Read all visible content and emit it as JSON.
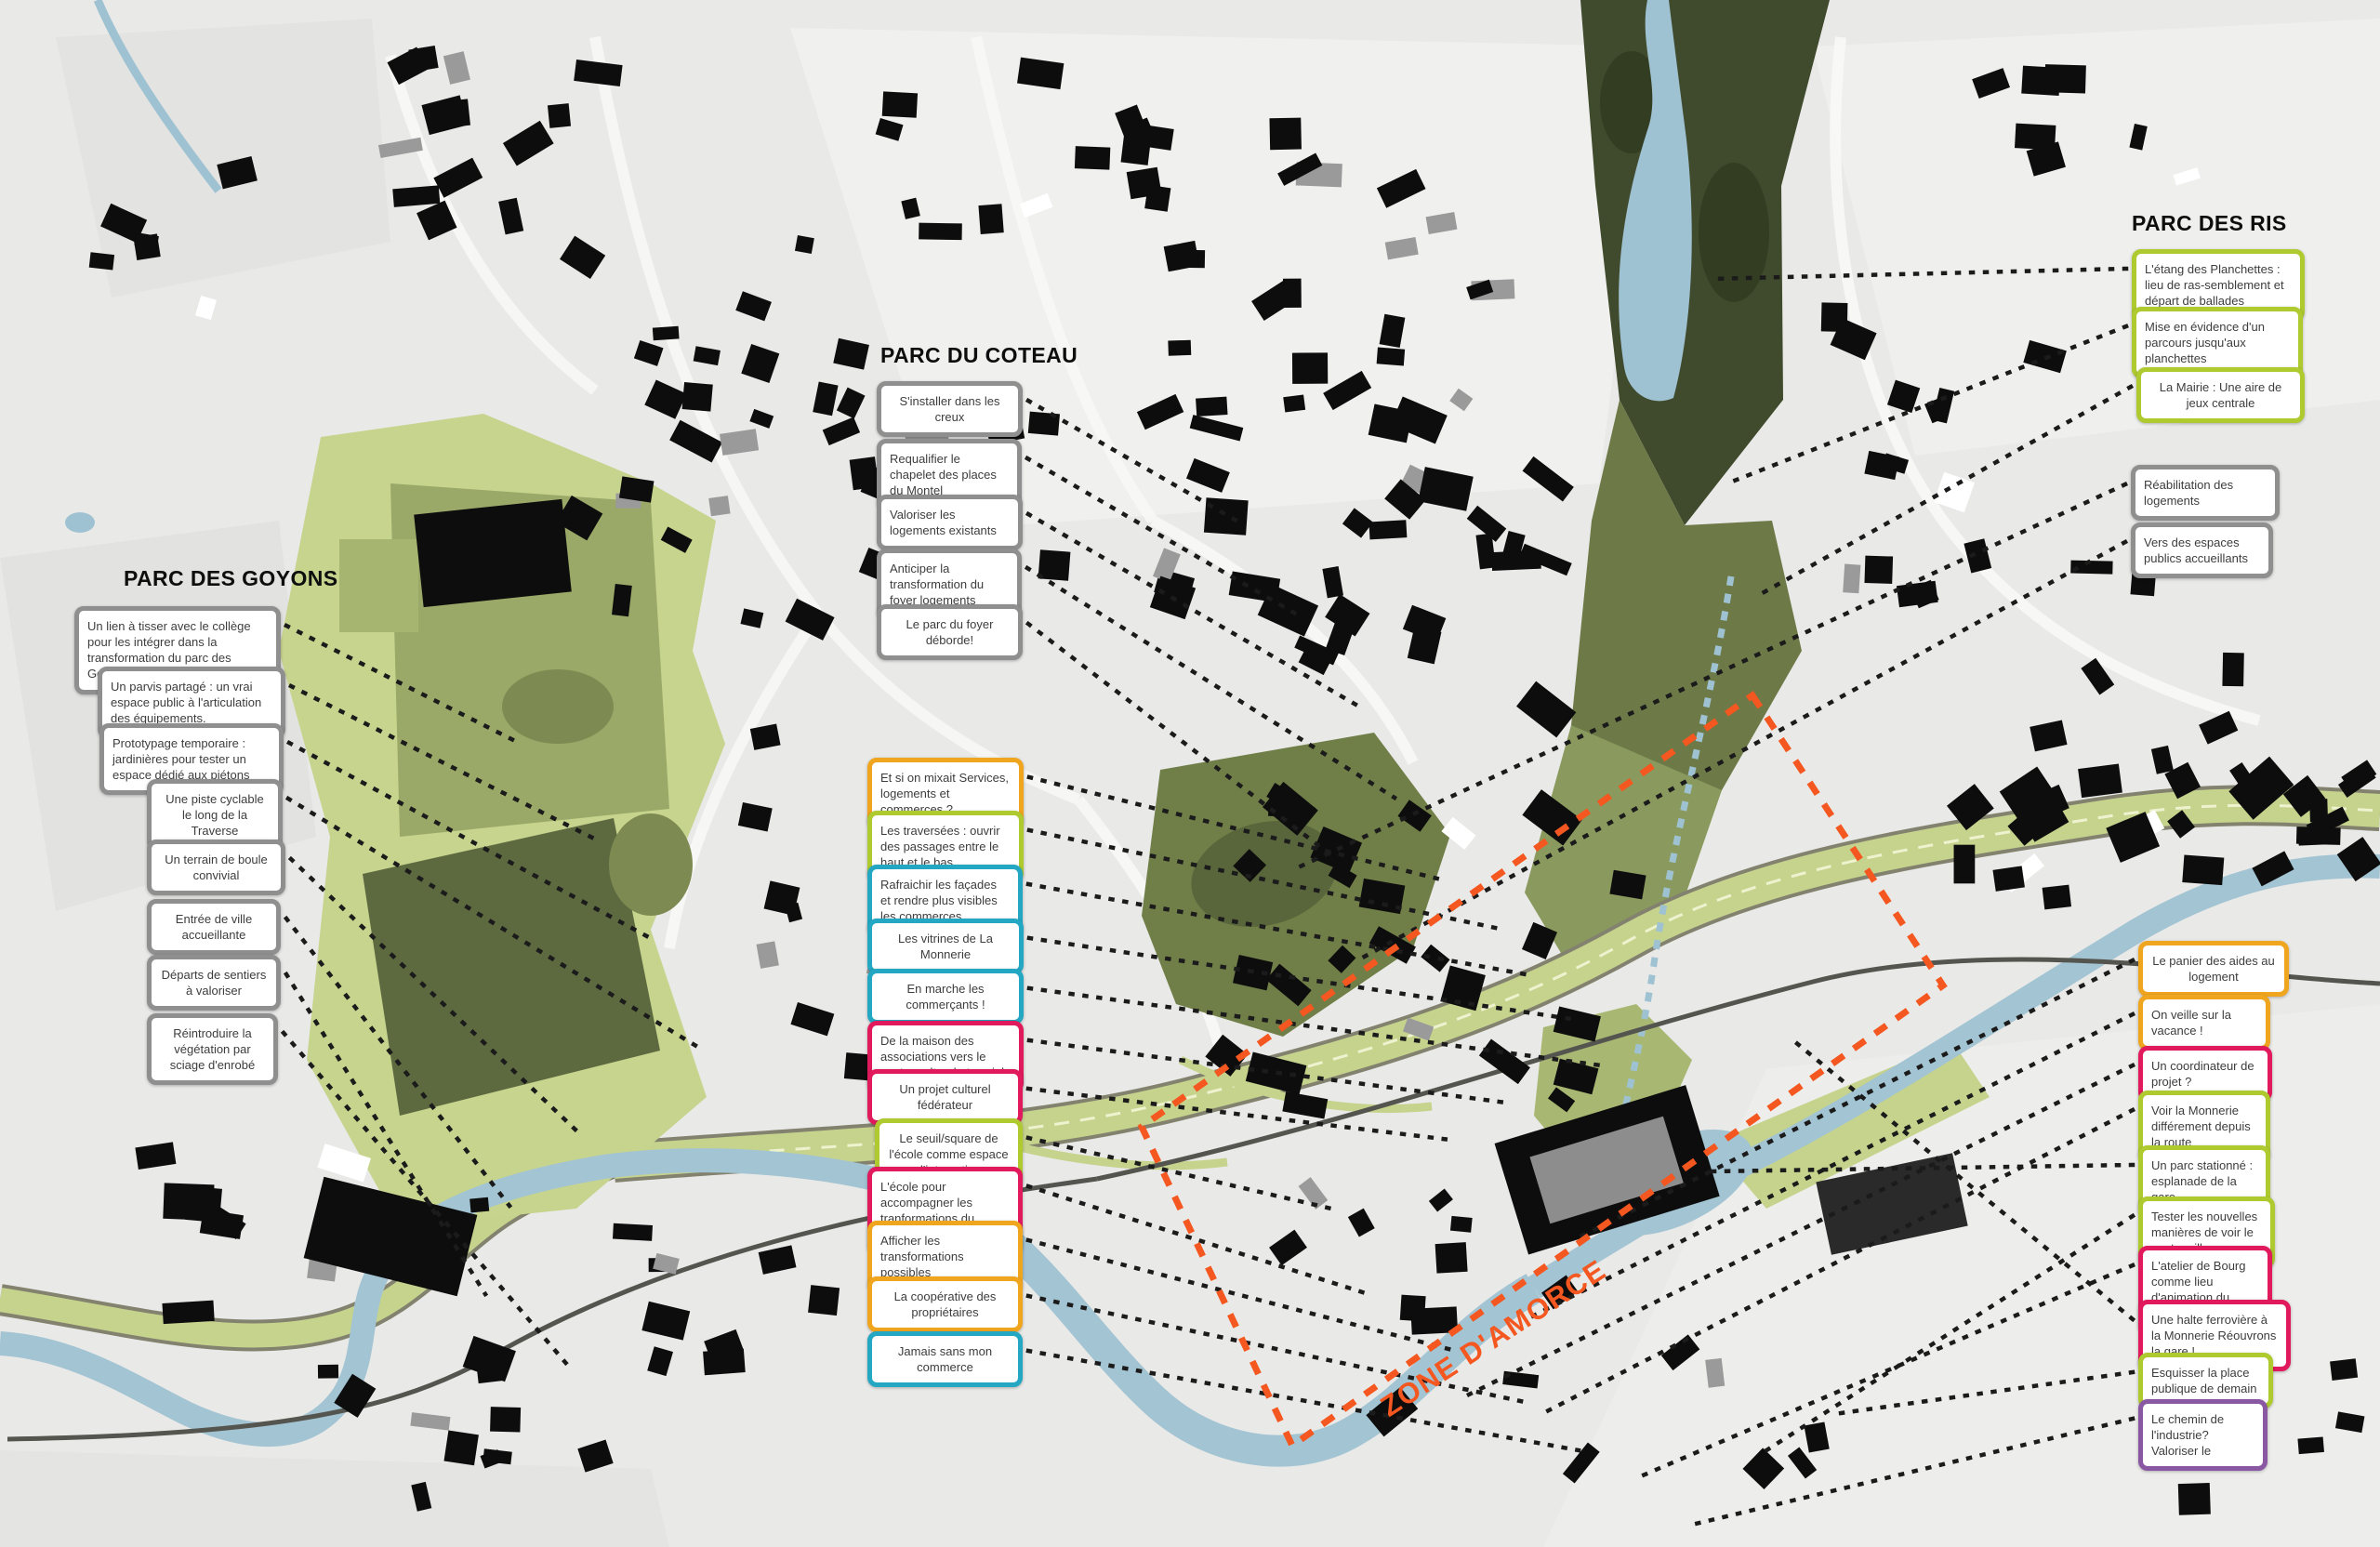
{
  "palette": {
    "gray": "#8f8f8f",
    "yellow": "#f0a51f",
    "green": "#aeca2f",
    "cyan": "#23a7c2",
    "pink": "#e01a5d",
    "purple": "#8a57a3",
    "orange": "#f4571f"
  },
  "map": {
    "zone_label": "ZONE D'AMORCE"
  },
  "groups": {
    "goyons": {
      "title": "PARC DES GOYONS",
      "boxes": [
        {
          "text": "Un lien à tisser avec le collège pour les intégrer dans la transformation du parc des Goyons",
          "color": "gray"
        },
        {
          "text": "Un parvis partagé : un vrai espace public à l'articulation des équipements.",
          "color": "gray"
        },
        {
          "text": "Prototypage temporaire : jardinières pour tester un espace dédié aux piétons",
          "color": "gray"
        },
        {
          "text": "Une piste cyclable le long de la Traverse",
          "color": "gray"
        },
        {
          "text": "Un terrain de boule convivial",
          "color": "gray"
        },
        {
          "text": "Entrée de ville accueillante",
          "color": "gray"
        },
        {
          "text": "Départs de sentiers à valoriser",
          "color": "gray"
        },
        {
          "text": "Réintroduire la végétation par sciage d'enrobé",
          "color": "gray"
        }
      ]
    },
    "coteau": {
      "title": "PARC DU COTEAU",
      "boxes": [
        {
          "text": "S'installer dans les creux",
          "color": "gray"
        },
        {
          "text": "Requalifier le chapelet des places du Montel",
          "color": "gray"
        },
        {
          "text": "Valoriser les logements existants",
          "color": "gray"
        },
        {
          "text": "Anticiper la transformation du foyer logements",
          "color": "gray"
        },
        {
          "text": "Le parc du foyer déborde!",
          "color": "gray"
        }
      ]
    },
    "ris": {
      "title": "PARC DES RIS",
      "boxes": [
        {
          "text": "L'étang des Planchettes : lieu de ras-semblement et départ de ballades",
          "color": "green"
        },
        {
          "text": "Mise en évidence d'un parcours jusqu'aux planchettes",
          "color": "green"
        },
        {
          "text": "La Mairie : Une aire de jeux centrale",
          "color": "green"
        },
        {
          "text": "Réabilitation des logements",
          "color": "gray"
        },
        {
          "text": "Vers des espaces publics accueillants",
          "color": "gray"
        }
      ]
    },
    "center": {
      "title": null,
      "boxes": [
        {
          "text": "Et si on mixait Services, logements et commerces ?",
          "color": "yellow"
        },
        {
          "text": "Les traversées : ouvrir des passages entre le haut et le bas",
          "color": "green"
        },
        {
          "text": "Rafraichir les façades et rendre plus visibles les commerces",
          "color": "cyan"
        },
        {
          "text": "Les vitrines de La Monnerie",
          "color": "cyan"
        },
        {
          "text": "En marche les commerçants !",
          "color": "cyan"
        },
        {
          "text": "De la maison des associations vers le centre culturel et social",
          "color": "pink"
        },
        {
          "text": "Un projet culturel fédérateur",
          "color": "pink"
        },
        {
          "text": "Le seuil/square de l'école comme espace d'interaction",
          "color": "green"
        },
        {
          "text": "L'école pour accompagner les tranformations du Bourg",
          "color": "pink"
        },
        {
          "text": "Afficher les transformations possibles",
          "color": "yellow"
        },
        {
          "text": "La coopérative des propriétaires",
          "color": "yellow"
        },
        {
          "text": "Jamais sans mon commerce",
          "color": "cyan"
        }
      ]
    },
    "right": {
      "title": null,
      "boxes": [
        {
          "text": "Le panier des aides au logement",
          "color": "yellow"
        },
        {
          "text": "On veille sur la vacance !",
          "color": "yellow"
        },
        {
          "text": "Un coordinateur de projet ?",
          "color": "pink"
        },
        {
          "text": "Voir la Monnerie différement depuis la route",
          "color": "green"
        },
        {
          "text": "Un parc stationné : esplanade de la gare",
          "color": "green"
        },
        {
          "text": "Tester les nouvelles manières de voir le centre ville",
          "color": "green"
        },
        {
          "text": "L'atelier de Bourg comme lieu d'animation du centre bourg",
          "color": "pink"
        },
        {
          "text": "Une halte ferrovière à la Monnerie Réouvrons la gare !",
          "color": "pink"
        },
        {
          "text": "Esquisser la place publique de demain",
          "color": "green"
        },
        {
          "text": "Le chemin de l'industrie? Valoriser le",
          "color": "purple"
        }
      ]
    }
  }
}
